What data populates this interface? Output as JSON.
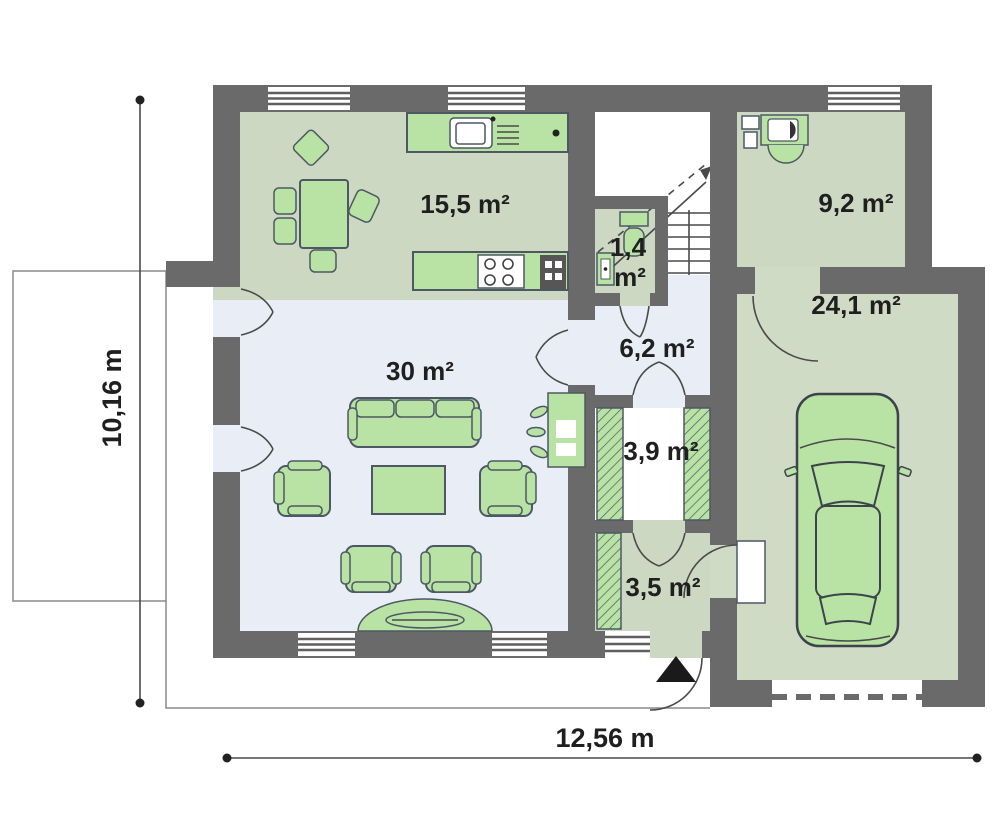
{
  "plan": {
    "rooms": {
      "kitchen": {
        "label": "15,5 m²"
      },
      "living": {
        "label": "30 m²"
      },
      "wc": {
        "line1": "1,4",
        "line2": "m²"
      },
      "hall": {
        "label": "6,2 m²"
      },
      "wardrobe": {
        "label": "3,9 m²"
      },
      "entry": {
        "label": "3,5 m²"
      },
      "utility": {
        "label": "9,2 m²"
      },
      "garage": {
        "label": "24,1 m²"
      }
    },
    "dimensions": {
      "width": "12,56 m",
      "height": "10,16 m"
    }
  },
  "colors": {
    "wall": "#6a6a6a",
    "room-green": "#ccd8c2",
    "room-blue": "#e9eef6",
    "garage-floor": "#d0dbc5",
    "furniture-green": "#b9e3a4",
    "outline": "#4d5864",
    "label": "#1f1f1f",
    "line": "#4a4a4a",
    "thin-line": "#8a8a8a"
  }
}
